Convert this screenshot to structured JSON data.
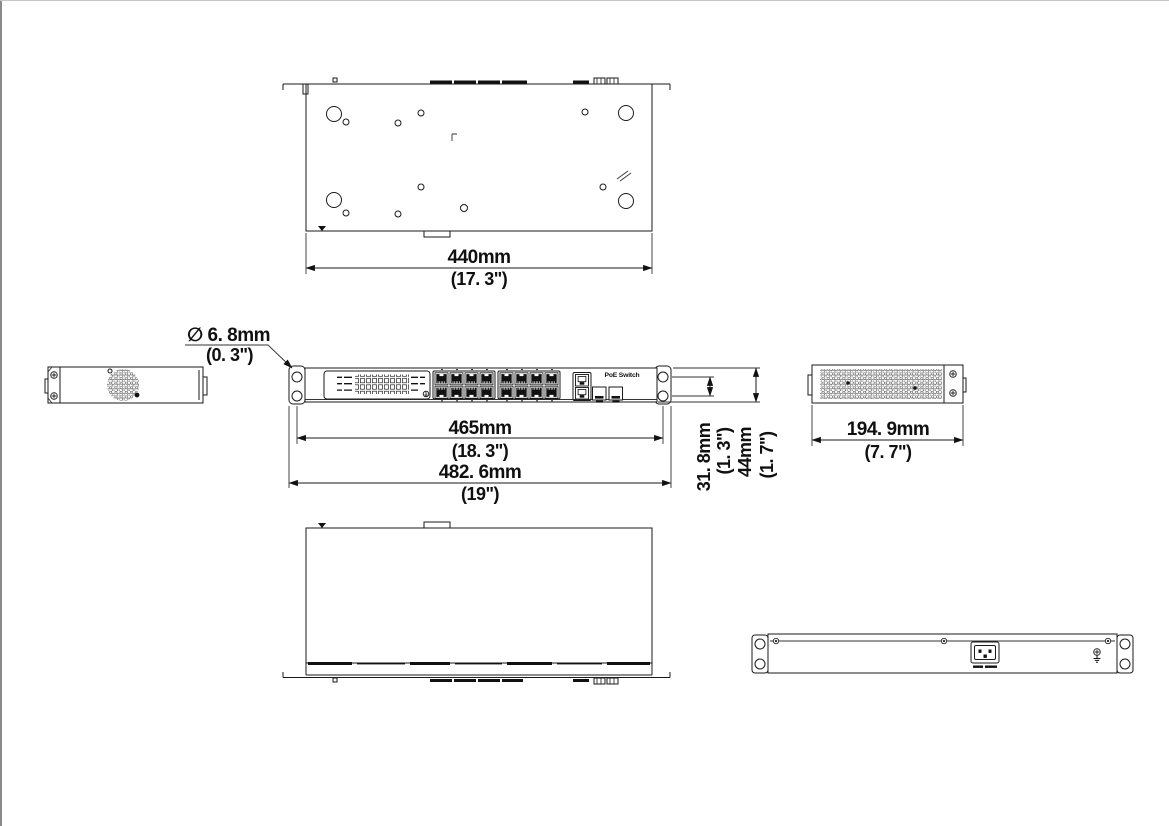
{
  "labels": {
    "product": "PoE Switch"
  },
  "dimensions": {
    "top_view": {
      "width_mm": "440mm",
      "width_in": "(17. 3\")"
    },
    "front_view": {
      "ear_hole_diameter_mm": "∅ 6. 8mm",
      "ear_hole_diameter_in": "(0. 3\")",
      "mounting_hole_span_mm": "465mm",
      "mounting_hole_span_in": "(18. 3\")",
      "overall_width_mm": "482. 6mm",
      "overall_width_in": "(19\")",
      "ear_hole_pitch_mm": "31. 8mm",
      "ear_hole_pitch_in": "(1. 3\")",
      "overall_height_mm": "44mm",
      "overall_height_in": "(1. 7\")"
    },
    "side_view": {
      "depth_mm": "194. 9mm",
      "depth_in": "(7. 7\")"
    }
  }
}
